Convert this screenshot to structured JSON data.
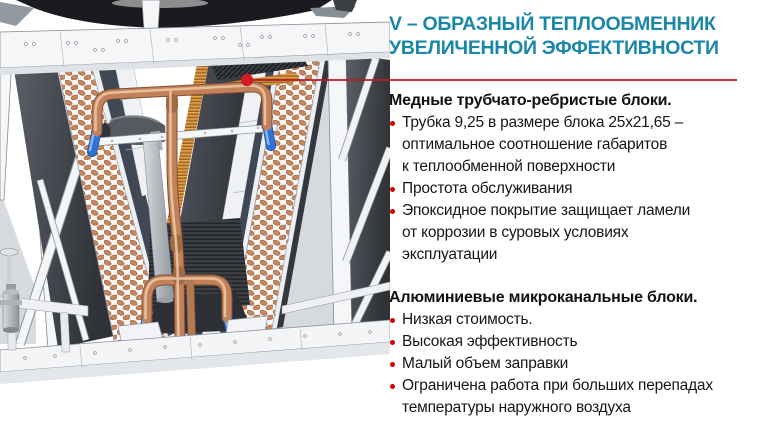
{
  "title": {
    "line1": "V – ОБРАЗНЫЙ ТЕПЛООБМЕННИК",
    "line2": "УВЕЛИЧЕННОЙ ЭФФЕКТИВНОСТИ"
  },
  "sections": [
    {
      "heading": "Медные трубчато-ребристые блоки.",
      "bullets": [
        "Трубка 9,25 в размере блока 25х21,65 –\nоптимальное соотношение габаритов\nк теплообменной поверхности",
        "Простота обслуживания",
        "Эпоксидное покрытие защищает ламели\nот коррозии в суровых условиях\nэксплуатации"
      ]
    },
    {
      "heading": "Алюминиевые микроканальные блоки.",
      "bullets": [
        "Низкая стоимость.",
        "Высокая эффективность",
        "Малый объем заправки",
        "Ограничена работа при больших перепадах\nтемпературы наружного воздуха"
      ]
    }
  ],
  "colors": {
    "title_teal": "#1a87a9",
    "callout_red": "#b81d23",
    "callout_dot_red": "#d11c25",
    "bullet_red": "#cc0000",
    "body_text": "#161616",
    "copper_pipe": "#c28159",
    "blue_sleeve": "#2e74d8"
  }
}
